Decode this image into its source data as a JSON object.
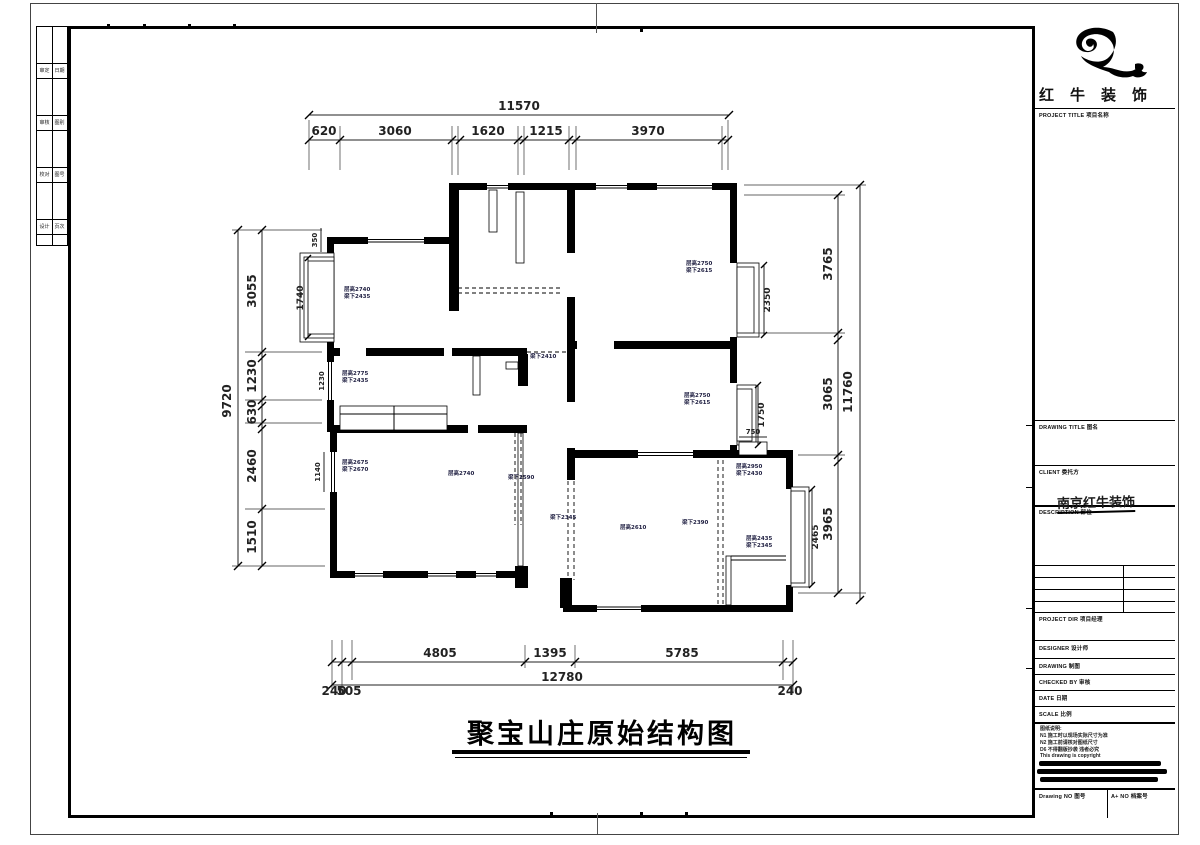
{
  "sheet": {
    "main_title": "聚宝山庄原始结构图"
  },
  "logo": {
    "company_spaced": "红牛装饰"
  },
  "title_block": {
    "project_title_label": "PROJECT TITLE 项目名称",
    "drawing_title_label": "DRAWING TITLE 图名",
    "client_label": "CLIENT 委托方",
    "description_label": "DESCRIPTION 部位",
    "description_value": "南京红牛装饰",
    "project_dir_label": "PROJECT DIR 项目经理",
    "designer_label": "DESIGNER 设计师",
    "drawing_label": "DRAWING 制图",
    "checked_label": "CHECKED BY 审核",
    "date_label": "DATE 日期",
    "scale_label": "SCALE 比例",
    "notes": [
      "图纸说明:",
      "N1 施工时以现场实际尺寸为准",
      "N2 施工前请核对图纸尺寸",
      "D6 不得翻版抄袭 违者必究",
      "This drawing is copyright"
    ],
    "drawing_no_label": "Drawing NO 图号",
    "archive_no_label": "A+ NO 档案号"
  },
  "strip": {
    "rows": [
      {
        "a": "审定",
        "b": "日期"
      },
      {
        "a": "审核",
        "b": "图别"
      },
      {
        "a": "校对",
        "b": "图号"
      },
      {
        "a": "设计",
        "b": "页次"
      }
    ]
  },
  "dims": {
    "top_total": "11570",
    "top_segs": [
      "620",
      "3060",
      "1620",
      "1215",
      "3970"
    ],
    "left_total": "9720",
    "left_segs": [
      "3055",
      "1230",
      "630",
      "2460",
      "1510"
    ],
    "right_total": "11760",
    "right_segs": [
      "3765",
      "3065",
      "3965"
    ],
    "bottom_segs": [
      "4805",
      "1395",
      "5785"
    ],
    "bottom_total": "12780",
    "bottom_left_a": "240",
    "bottom_left_b": "505",
    "bottom_right": "240",
    "inner": {
      "balcony_h": "1740",
      "balcony_t": "350",
      "win_left_mid": "1230",
      "win_left_low": "1140",
      "win_r1": "2350",
      "win_r2": "1750",
      "win_r3": "2465",
      "niche": "750"
    }
  },
  "rooms": {
    "tl1": "层高2740",
    "tl2": "梁下2435",
    "tr1": "层高2750",
    "tr2": "梁下2615",
    "mr1": "层高2750",
    "mr2": "梁下2615",
    "hall1": "层高2775",
    "hall2": "梁下2435",
    "ll1": "层高2675",
    "ll2": "梁下2670",
    "lm1": "层高2740",
    "lm2": "梁下2590",
    "beam": "梁下2410",
    "lv1": "梁下2345",
    "lv2": "层高2610",
    "lv3": "梁下2390",
    "rr1": "层高2950",
    "rr2": "梁下2430",
    "sr1": "层高2435",
    "sr2": "梁下2345"
  }
}
